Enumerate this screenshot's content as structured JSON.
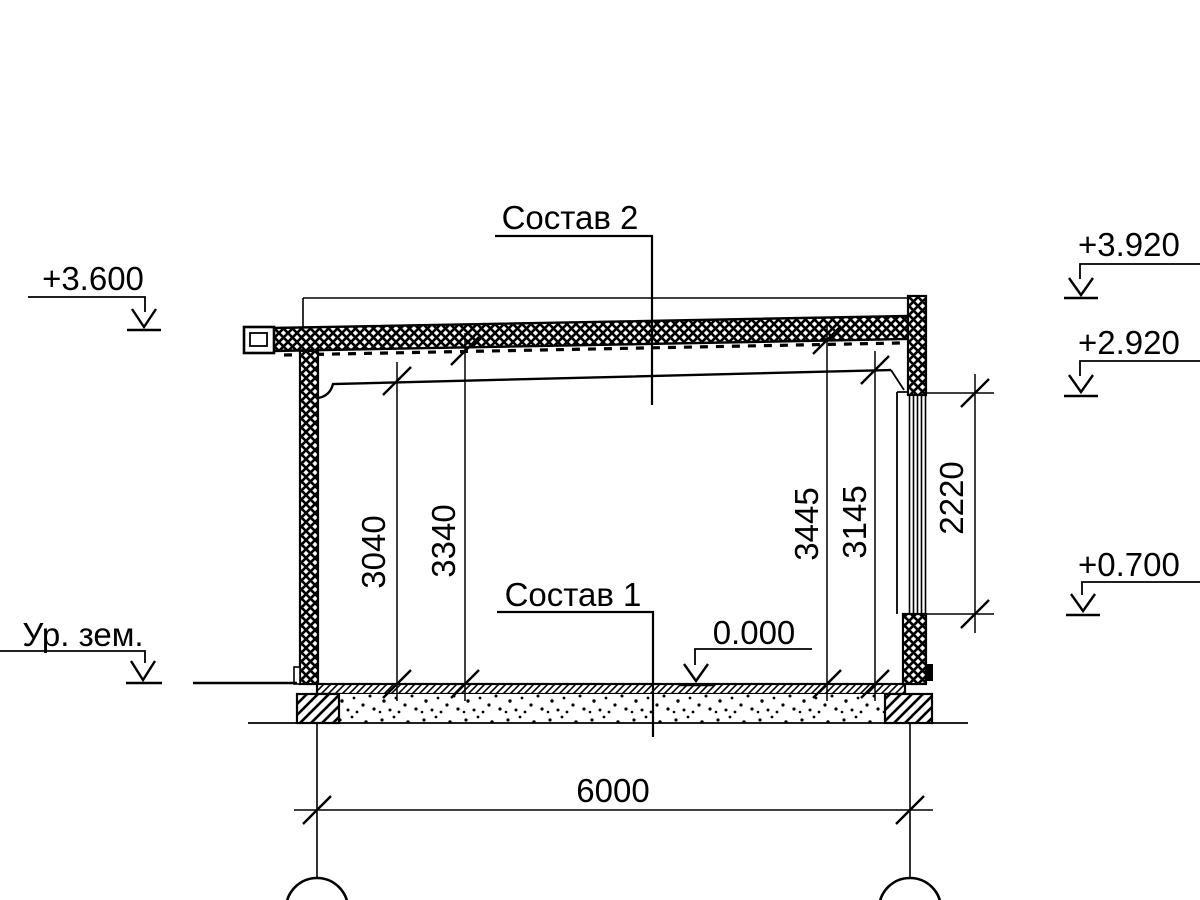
{
  "page": {
    "background": "#ffffff",
    "ink": "#000000"
  },
  "section_drawing": {
    "labels": {
      "roof_assembly": "Состав 2",
      "floor_assembly": "Состав 1"
    },
    "elevation_marks": {
      "roof_edge_left": "+3.600",
      "ground_level": "Ур. зем.",
      "parapet_top": "+3.920",
      "window_head": "+2.920",
      "window_sill": "+0.700",
      "finished_floor": "0.000"
    },
    "dimensions": {
      "clear_height_left": "3040",
      "structure_height_left": "3340",
      "structure_height_right": "3445",
      "clear_height_right": "3145",
      "window_opening": "2220",
      "axis_span": "6000"
    }
  }
}
